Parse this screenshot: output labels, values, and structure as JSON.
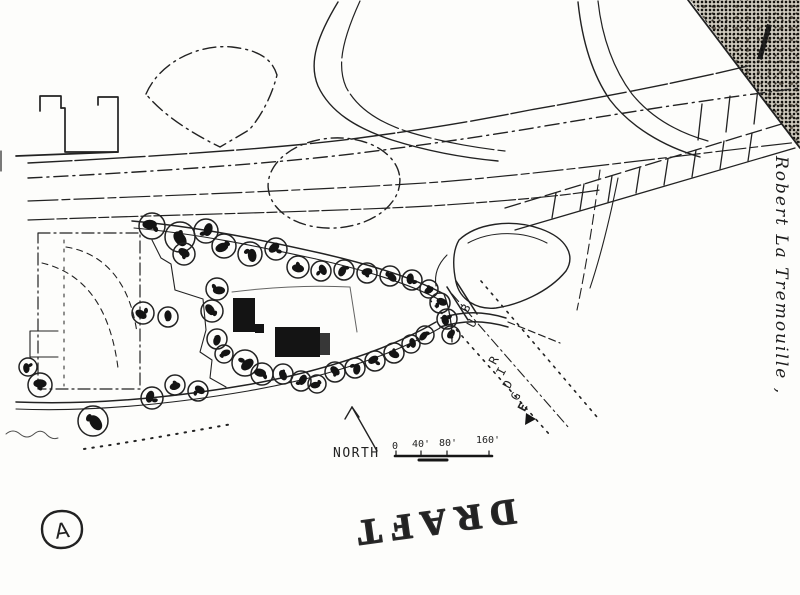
{
  "colors": {
    "ink": "#222222",
    "paper": "#fdfdfb",
    "tree_fill": "#141414"
  },
  "annotations": {
    "north_label": "NORTH",
    "scale_labels": [
      "0",
      "40'",
      "80'",
      "160'"
    ],
    "draft_label": "DRAFT",
    "sheet_letter": "A",
    "street_name_letters": [
      "B",
      "U",
      "R",
      "I",
      "D",
      "G",
      "E"
    ],
    "handwritten_note": "Robert La Tremouille ,"
  }
}
